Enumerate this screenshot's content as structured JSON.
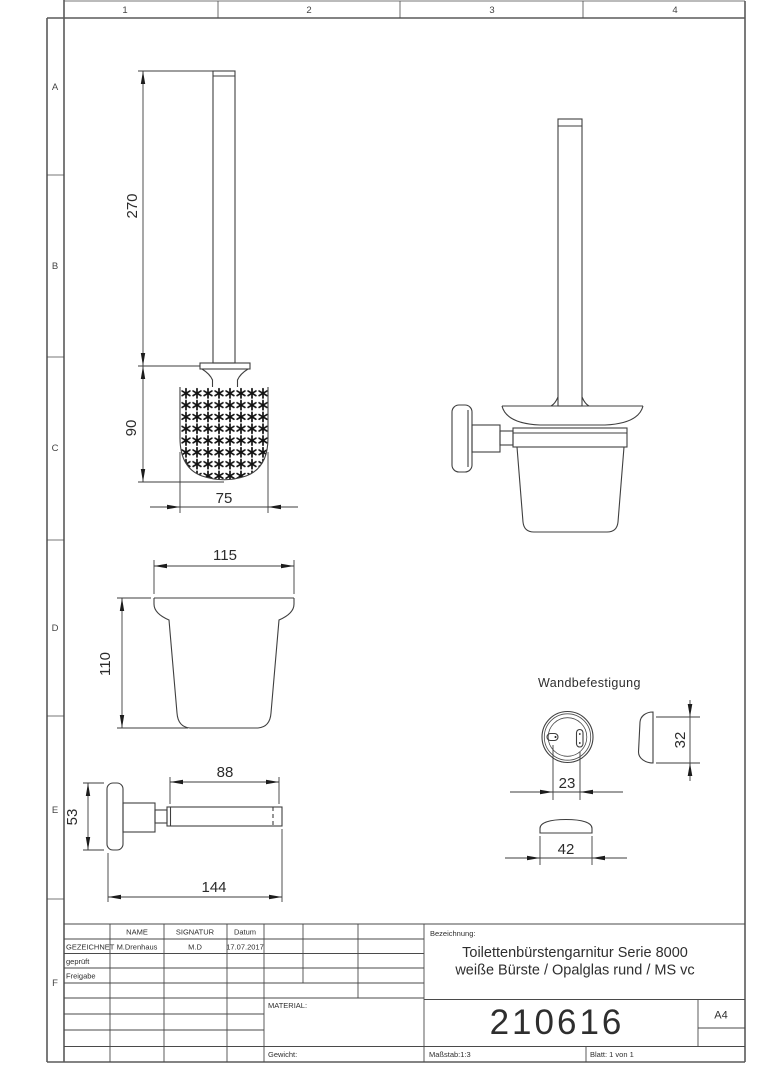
{
  "drawing": {
    "grid": {
      "columns": [
        "1",
        "2",
        "3",
        "4"
      ],
      "rows": [
        "A",
        "B",
        "C",
        "D",
        "E",
        "F"
      ]
    },
    "dimensions": {
      "handle_length": "270",
      "head_height": "90",
      "head_width": "75",
      "glass_width": "115",
      "glass_height": "110",
      "plate_height": "53",
      "arm_length": "88",
      "total_depth": "144",
      "hole_spacing": "23",
      "mount_depth": "32",
      "cap_width": "42"
    },
    "labels": {
      "wall_mount_title": "Wandbefestigung"
    },
    "title_block": {
      "col_name": "NAME",
      "col_signatur": "SIGNATUR",
      "col_datum": "Datum",
      "row_drawn_label": "GEZEICHNET",
      "row_drawn_name": "M.Drenhaus",
      "row_drawn_sig": "M.D",
      "row_drawn_date": "17.07.2017",
      "row_checked_label": "geprüft",
      "row_release_label": "Freigabe",
      "material_label": "MATERIAL:",
      "weight_label": "Gewicht:",
      "designation_label": "Bezeichnung:",
      "designation_line1": "Toilettenbürstengarnitur Serie 8000",
      "designation_line2": "weiße Bürste / Opalglas rund / MS vc",
      "part_number": "210616",
      "paper_format": "A4",
      "scale": "Maßstab:1:3",
      "sheet": "Blatt: 1 von 1"
    }
  }
}
